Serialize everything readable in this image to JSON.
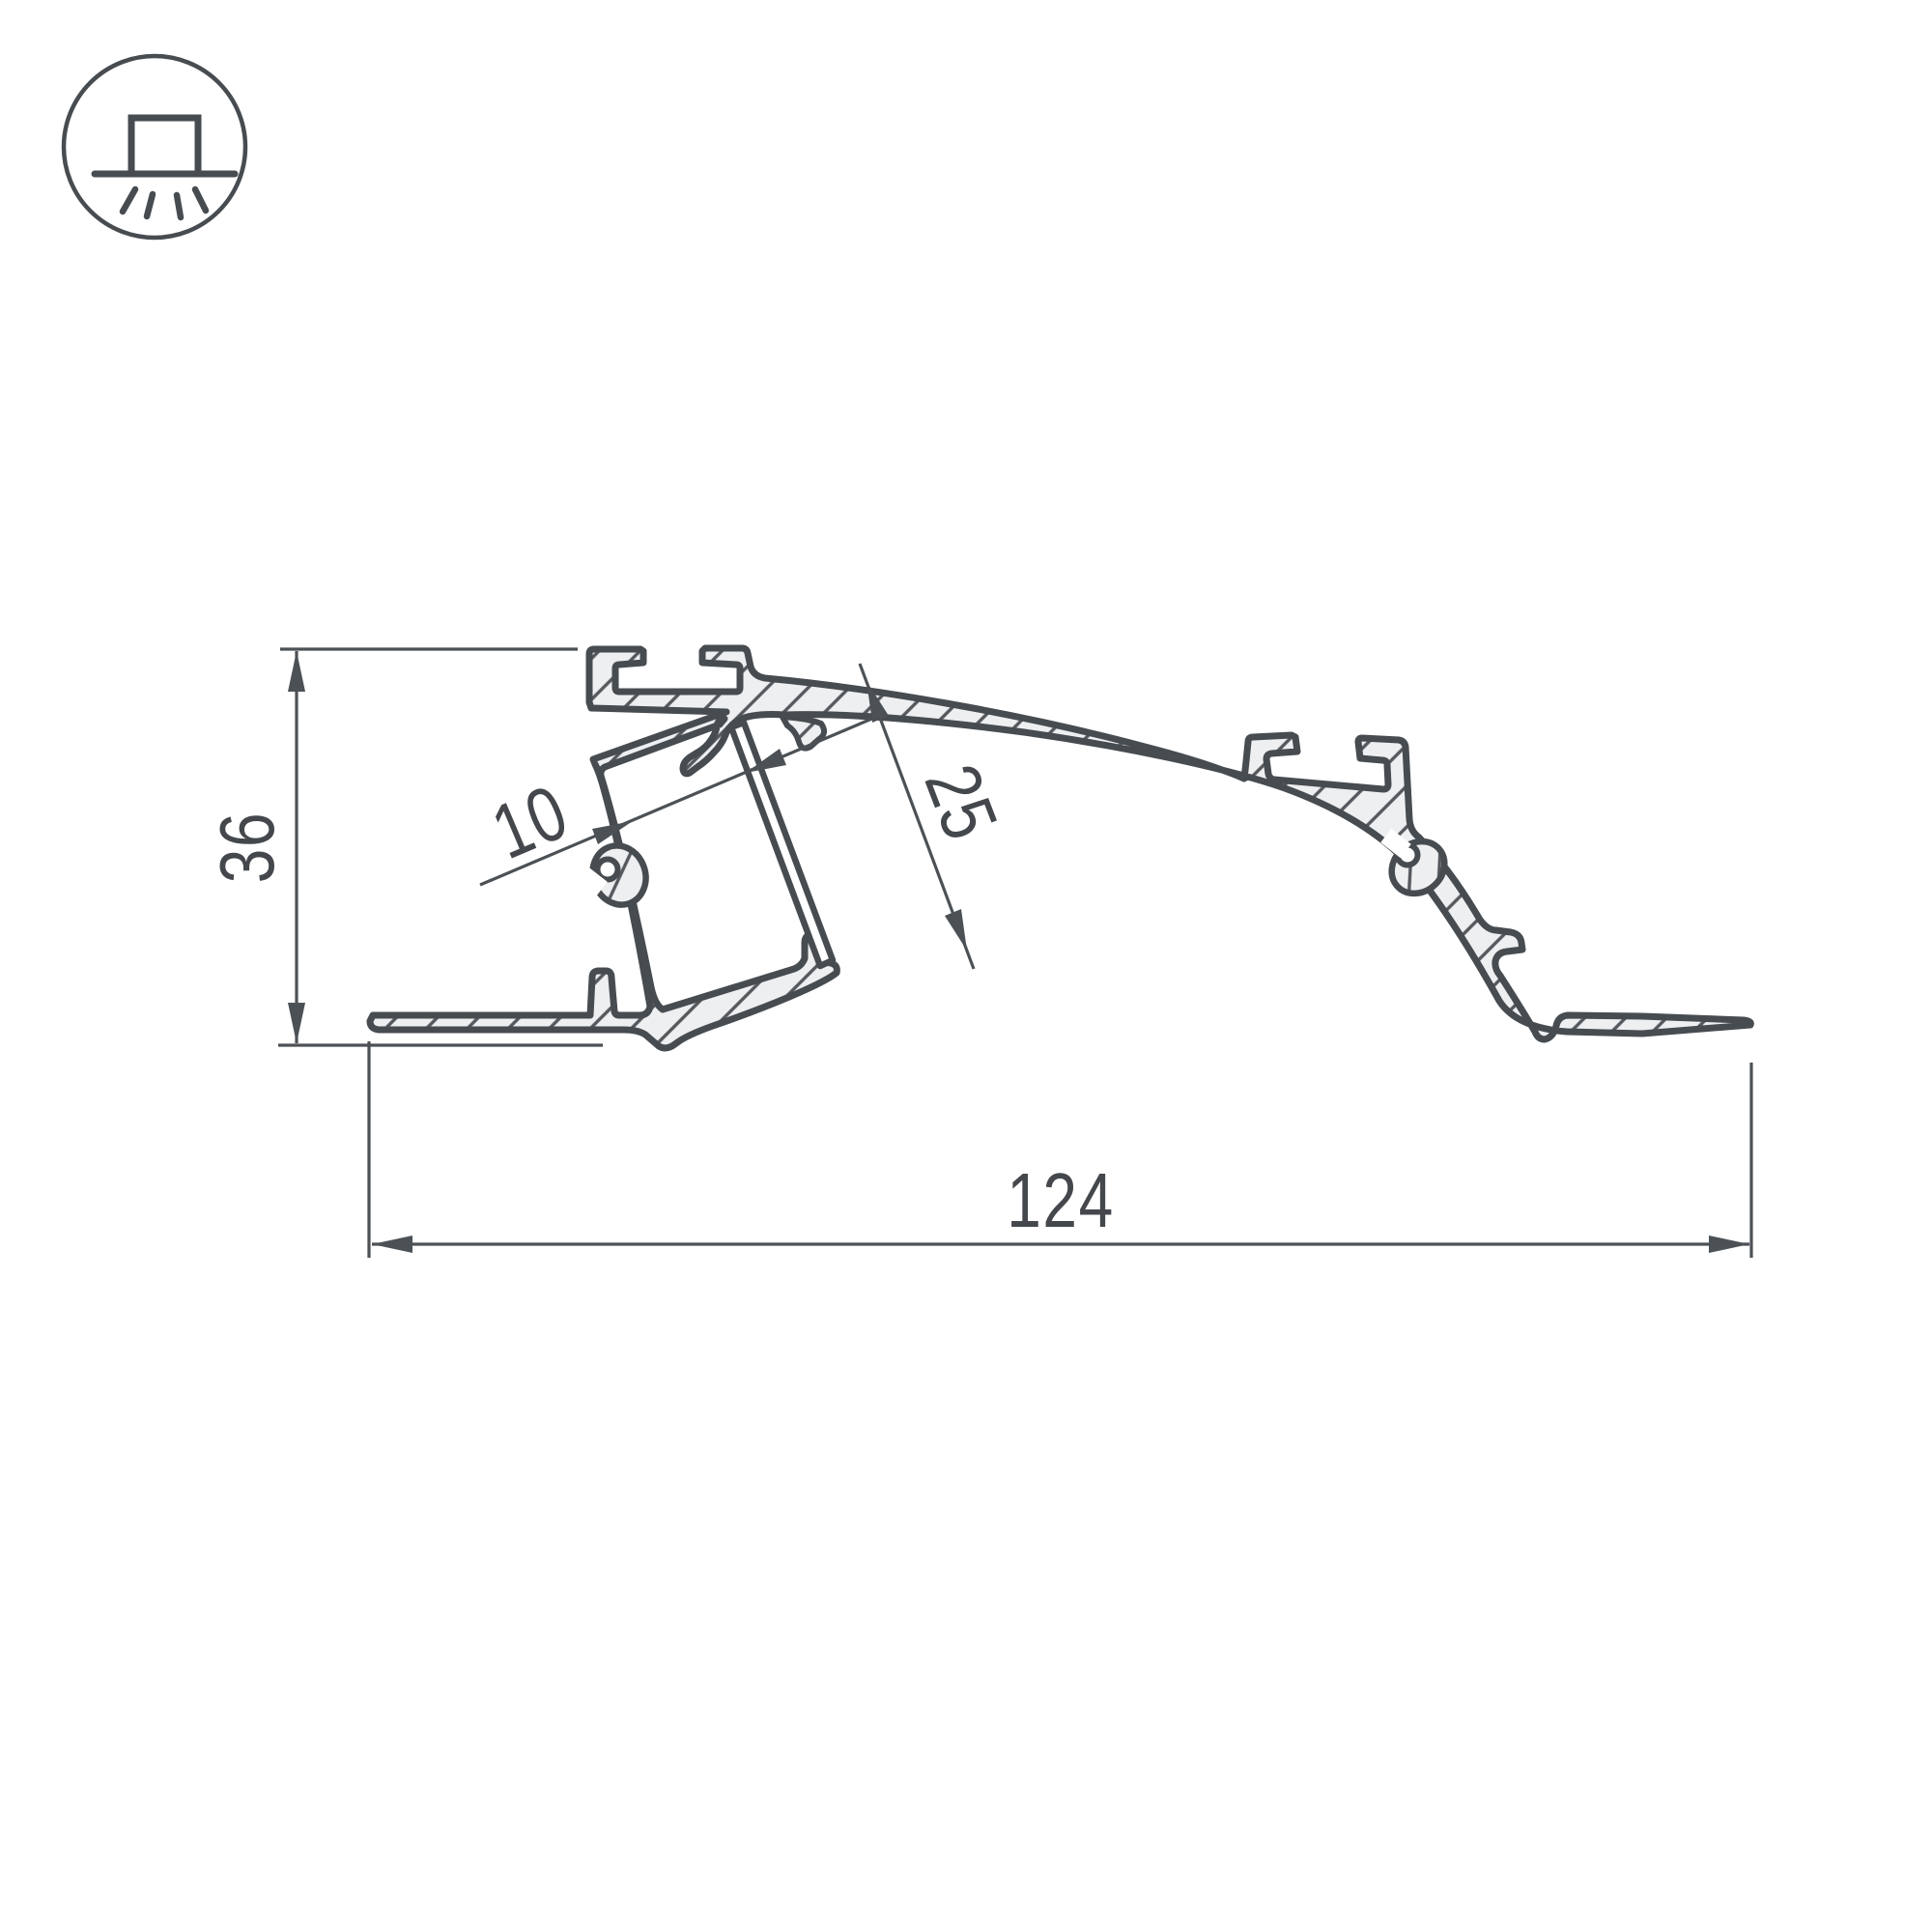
{
  "drawing": {
    "title": "led-profile-cross-section",
    "units": "mm"
  },
  "icon": {
    "name": "recessed-downlight-icon",
    "meaning": "surface light emitting downward"
  },
  "dimensions": {
    "overall_height": "36",
    "overall_width": "124",
    "channel_inner_width": "10",
    "channel_depth": "25"
  },
  "colors": {
    "outline": "#474C51",
    "fill": "#EDEFF0",
    "hatch": "#55595E",
    "dimension": "#4C5156",
    "text": "#44484C",
    "background": "#FFFFFF",
    "diffuser_fill": "#FFFFFF"
  }
}
